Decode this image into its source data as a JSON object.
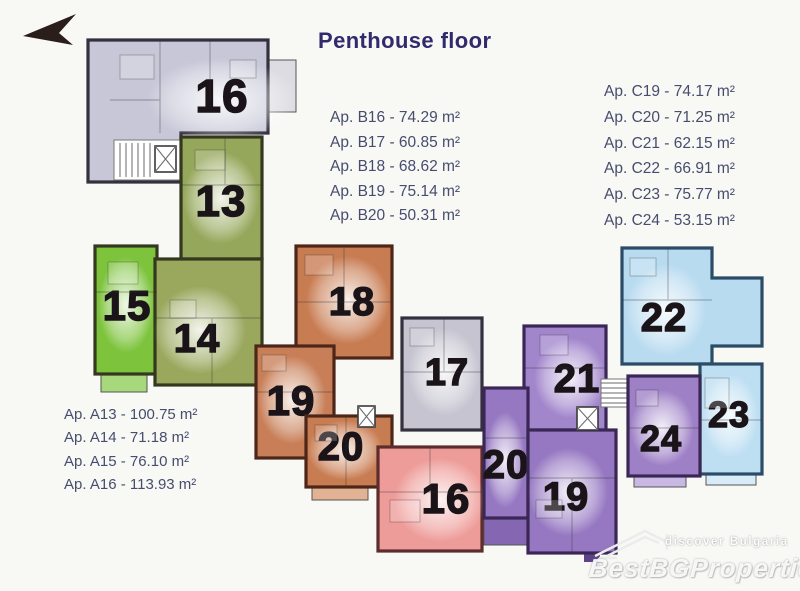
{
  "title": "Penthouse floor",
  "colors": {
    "title": "#312b6d",
    "list_text": "#474d6e",
    "background": "#f8f8f5",
    "wall": "#2b242b",
    "unit_number": "#1a1418"
  },
  "apartment_lists": {
    "b": [
      "Ap. B16 - 74.29 m²",
      "Ap. B17 - 60.85 m²",
      "Ap. B18 - 68.62 m²",
      "Ap. B19 - 75.14 m²",
      "Ap. B20 - 50.31 m²"
    ],
    "c": [
      "Ap. C19 - 74.17 m²",
      "Ap. C20 - 71.25 m²",
      "Ap. C21 - 62.15 m²",
      "Ap. C22 - 66.91 m²",
      "Ap. C23 - 75.77 m²",
      "Ap. C24 - 53.15 m²"
    ],
    "a": [
      "Ap. A13 - 100.75 m²",
      "Ap. A14 - 71.18 m²",
      "Ap. A15 - 76.10 m²",
      "Ap. A16 - 113.93 m²"
    ]
  },
  "units": [
    {
      "id": "A16",
      "number": "16",
      "color": "#c7c7d8"
    },
    {
      "id": "A13",
      "number": "13",
      "color": "#95a75a"
    },
    {
      "id": "A15",
      "number": "15",
      "color": "#7dc33c"
    },
    {
      "id": "A14",
      "number": "14",
      "color": "#9aa85e"
    },
    {
      "id": "B18",
      "number": "18",
      "color": "#c87c52"
    },
    {
      "id": "B19",
      "number": "19",
      "color": "#c87f58"
    },
    {
      "id": "B20",
      "number": "20",
      "color": "#c87c52"
    },
    {
      "id": "B17",
      "number": "17",
      "color": "#c6c4d0"
    },
    {
      "id": "B16",
      "number": "16",
      "color": "#ee9c99"
    },
    {
      "id": "C21",
      "number": "21",
      "color": "#a286cc"
    },
    {
      "id": "C20",
      "number": "20",
      "color": "#9678c2"
    },
    {
      "id": "C19",
      "number": "19",
      "color": "#9678c2"
    },
    {
      "id": "C22",
      "number": "22",
      "color": "#b9dbf0"
    },
    {
      "id": "C23",
      "number": "23",
      "color": "#bedff2"
    },
    {
      "id": "C24",
      "number": "24",
      "color": "#9e80c6"
    }
  ],
  "watermark": {
    "tagline": "discover Bulgaria",
    "brand": "BestBGProperties"
  }
}
